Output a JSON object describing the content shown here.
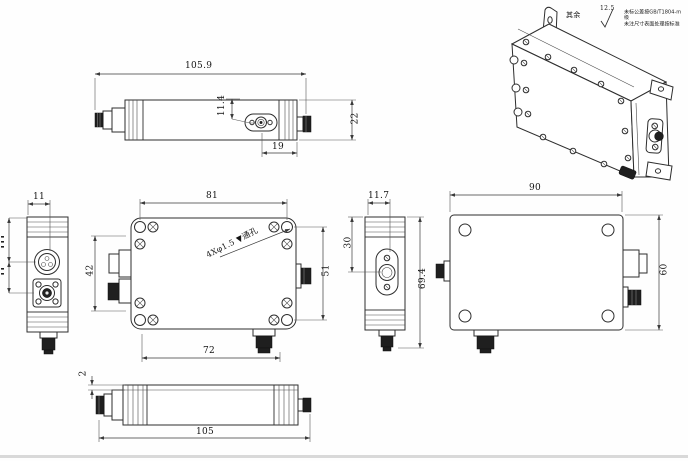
{
  "drawing_type": "mechanical multi-view drawing of RF module enclosure",
  "notes": {
    "rest_label": "其余",
    "roughness_value": "12.5",
    "tolerance_note_line1": "未标公差按GB/T1804-m级",
    "tolerance_note_line2": "未注尺寸表面处理按标准"
  },
  "views": {
    "top": {
      "dims": {
        "overall_length": "105.9",
        "body_height": "22",
        "port_center_offset": "11.4",
        "port_to_end": "19"
      }
    },
    "left": {
      "dims": {
        "edge_to_port": "11"
      }
    },
    "front": {
      "dims": {
        "mount_hole_pitch_h": "81",
        "port_pitch": "72",
        "mount_hole_pitch_v": "51",
        "connector_span": "42"
      },
      "hole_callout": "4Xφ1.5 ▼通孔"
    },
    "mid_side": {
      "dims": {
        "edge_to_port": "11.7",
        "top_to_port": "30",
        "overall_height": "69.4"
      }
    },
    "back": {
      "dims": {
        "body_width": "90",
        "body_height": "60"
      }
    },
    "bottom": {
      "dims": {
        "overall_length": "105",
        "lip_thickness": "2"
      }
    }
  }
}
